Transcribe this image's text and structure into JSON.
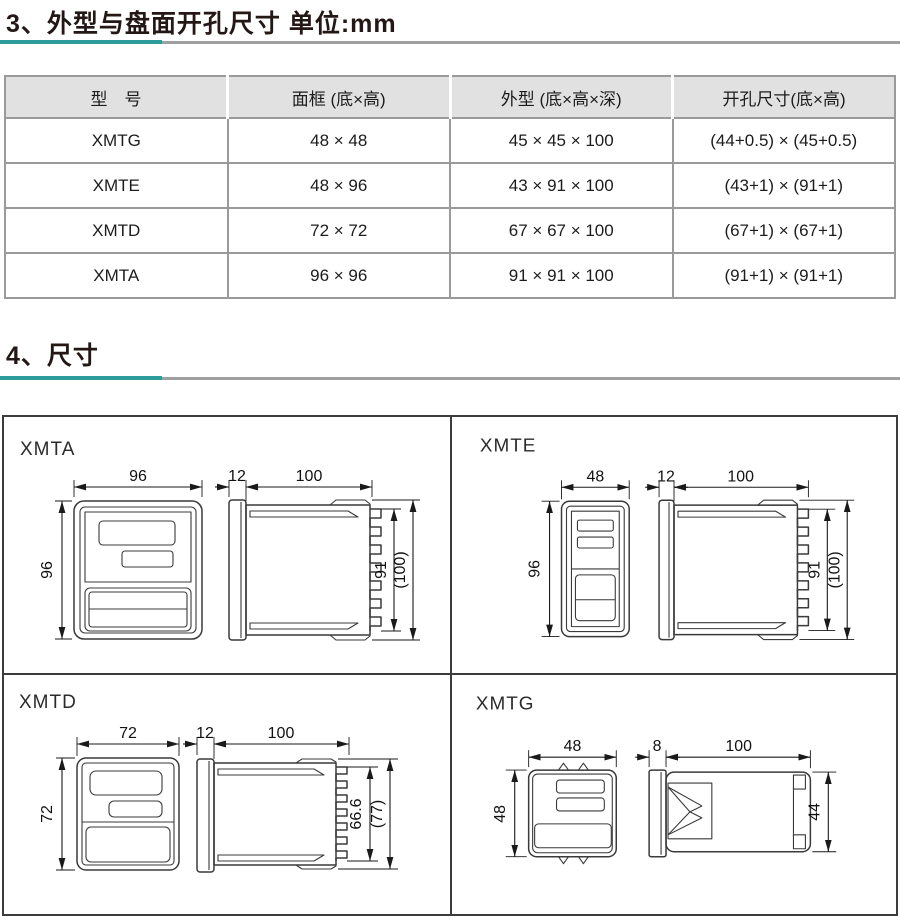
{
  "section3": {
    "title": "3、外型与盘面开孔尺寸 单位:mm"
  },
  "spec_table": {
    "headers": [
      "型　号",
      "面框 (底×高)",
      "外型 (底×高×深)",
      "开孔尺寸(底×高)"
    ],
    "rows": [
      {
        "model": "XMTG",
        "frame": "48 × 48",
        "outline": "45 × 45 × 100",
        "cutout": "(44+0.5) × (45+0.5)"
      },
      {
        "model": "XMTE",
        "frame": "48 × 96",
        "outline": "43 × 91 × 100",
        "cutout": "(43+1) × (91+1)"
      },
      {
        "model": "XMTD",
        "frame": "72 × 72",
        "outline": "67 × 67 × 100",
        "cutout": "(67+1) × (67+1)"
      },
      {
        "model": "XMTA",
        "frame": "96 × 96",
        "outline": "91 × 91 × 100",
        "cutout": "(91+1) × (91+1)"
      }
    ]
  },
  "section4": {
    "title": "4、尺寸"
  },
  "diagrams": {
    "xmta": {
      "label": "XMTA",
      "front_width": "96",
      "front_height": "96",
      "bezel_depth": "12",
      "body_depth": "100",
      "body_height": "91",
      "total_height": "(100)"
    },
    "xmte": {
      "label": "XMTE",
      "front_width": "48",
      "front_height": "96",
      "bezel_depth": "12",
      "body_depth": "100",
      "body_height": "91",
      "total_height": "(100)"
    },
    "xmtd": {
      "label": "XMTD",
      "front_width": "72",
      "front_height": "72",
      "bezel_depth": "12",
      "body_depth": "100",
      "body_height": "66.6",
      "total_height": "(77)"
    },
    "xmtg": {
      "label": "XMTG",
      "front_width": "48",
      "front_height": "48",
      "bezel_depth": "8",
      "body_depth": "100",
      "body_height": "44"
    }
  },
  "colors": {
    "accent_teal": "#2c9c9c",
    "rule_gray": "#a0a0a0",
    "table_header_bg": "#e2e1e1",
    "drawing_line": "#3a3a3a"
  }
}
